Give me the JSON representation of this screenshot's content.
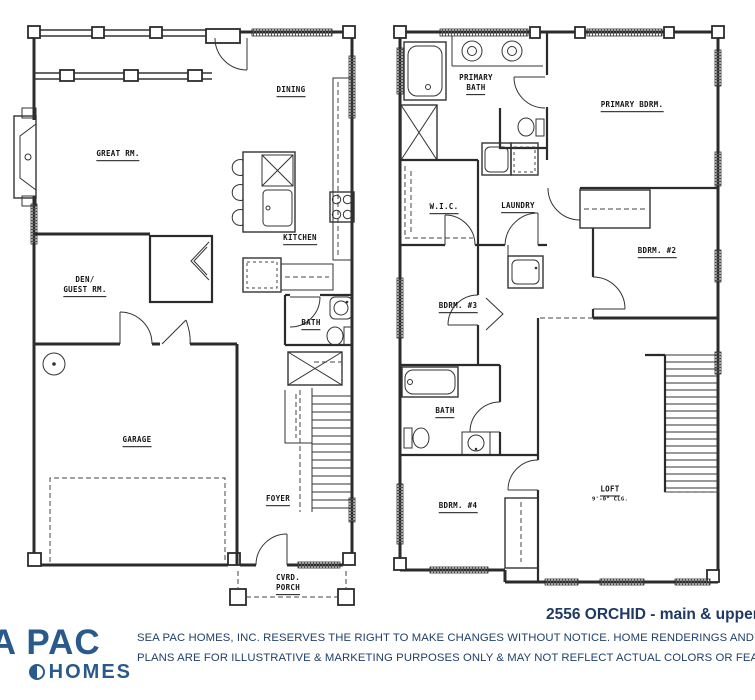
{
  "document": {
    "type": "floor-plan-sheet",
    "colors": {
      "wall": "#2b2b2b",
      "brand_navy": "#1f3864",
      "logo_blue": "#2a5a8c"
    }
  },
  "footer": {
    "plan_title": "2556 ORCHID - main & upper",
    "disclaimer_line1": "SEA PAC HOMES, INC. RESERVES THE RIGHT TO MAKE CHANGES WITHOUT NOTICE.  HOME RENDERINGS AND FLOOR",
    "disclaimer_line2": "PLANS ARE FOR ILLUSTRATIVE & MARKETING PURPOSES ONLY & MAY NOT REFLECT ACTUAL COLORS OR FEATURES.",
    "logo_line1": "SEA PAC",
    "logo_line2": "HOMES"
  },
  "main_floor": {
    "rooms": {
      "dining": "DINING",
      "great_rm": "GREAT RM.",
      "kitchen": "KITCHEN",
      "den_line1": "DEN/",
      "den_line2": "GUEST RM.",
      "bath": "BATH",
      "garage": "GARAGE",
      "foyer": "FOYER",
      "porch_line1": "CVRD.",
      "porch_line2": "PORCH"
    }
  },
  "upper_floor": {
    "rooms": {
      "primary_bath_line1": "PRIMARY",
      "primary_bath_line2": "BATH",
      "primary_bdrm": "PRIMARY BDRM.",
      "wic": "W.I.C.",
      "laundry": "LAUNDRY",
      "bdrm2": "BDRM. #2",
      "bdrm3": "BDRM. #3",
      "bath": "BATH",
      "bdrm4": "BDRM. #4",
      "loft": "LOFT",
      "loft_ceiling": "9'-0\" CLG."
    }
  }
}
